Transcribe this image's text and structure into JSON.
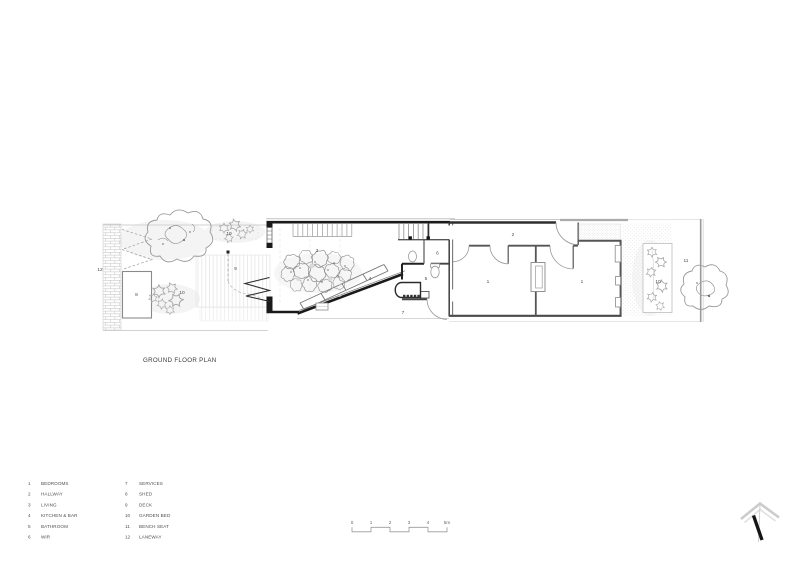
{
  "title": "GROUND FLOOR PLAN",
  "legend": {
    "items": [
      {
        "num": "1",
        "label": "BEDROOMS"
      },
      {
        "num": "2",
        "label": "HALLWAY"
      },
      {
        "num": "3",
        "label": "LIVING"
      },
      {
        "num": "4",
        "label": "KITCHEN & BAR"
      },
      {
        "num": "5",
        "label": "BATHROOM"
      },
      {
        "num": "6",
        "label": "WIR"
      },
      {
        "num": "7",
        "label": "SERVICES"
      },
      {
        "num": "8",
        "label": "SHED"
      },
      {
        "num": "9",
        "label": "DECK"
      },
      {
        "num": "10",
        "label": "GARDEN BED"
      },
      {
        "num": "11",
        "label": "BENCH SEAT"
      },
      {
        "num": "12",
        "label": "LANEWAY"
      }
    ]
  },
  "scale_bar": {
    "labels": [
      "0",
      "1",
      "2",
      "3",
      "4",
      "5m"
    ]
  },
  "plan_labels": {
    "bedroom_left": "1",
    "bedroom_right": "1",
    "hallway": "2",
    "living": "3",
    "kitchen_bar": "4",
    "bathroom": "5",
    "wir": "6",
    "services": "7",
    "shed": "8",
    "deck": "9",
    "garden_bed_rear": "10",
    "garden_bed_side": "10",
    "garden_bed_front": "10",
    "bench_seat": "11",
    "laneway": "12"
  },
  "colors": {
    "wall_ink": "#1a1a1a",
    "annotation_ink": "#4f4f4f",
    "light_line": "#c9c9c9",
    "paper": "#ffffff"
  }
}
